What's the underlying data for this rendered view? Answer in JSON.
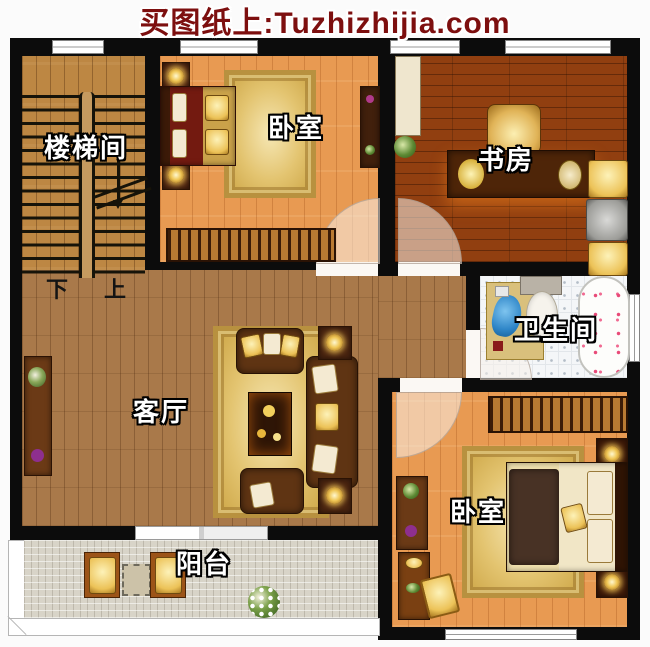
{
  "header": {
    "title": "买图纸上:Tuzhizhijia.com",
    "text_color": "#7d0f0f"
  },
  "floorplan": {
    "rooms": [
      {
        "id": "stairwell",
        "label": "楼梯间"
      },
      {
        "id": "bedroom-top",
        "label": "卧室"
      },
      {
        "id": "study",
        "label": "书房"
      },
      {
        "id": "bathroom",
        "label": "卫生间"
      },
      {
        "id": "living-room",
        "label": "客厅"
      },
      {
        "id": "bedroom-bottom",
        "label": "卧室"
      },
      {
        "id": "balcony",
        "label": "阳台"
      }
    ],
    "stair_directions": {
      "down": "下",
      "up": "上"
    },
    "colors": {
      "wall": "#0c0c0c",
      "stair_floor": "#bd8743",
      "bedroom_floor": "#e89a52",
      "study_floor": "#913f10",
      "living_floor": "#a9794a",
      "bathroom_floor": "#f4f6f8",
      "balcony_floor": "#d8d4c8",
      "rug_gold": "#e3c470"
    }
  }
}
